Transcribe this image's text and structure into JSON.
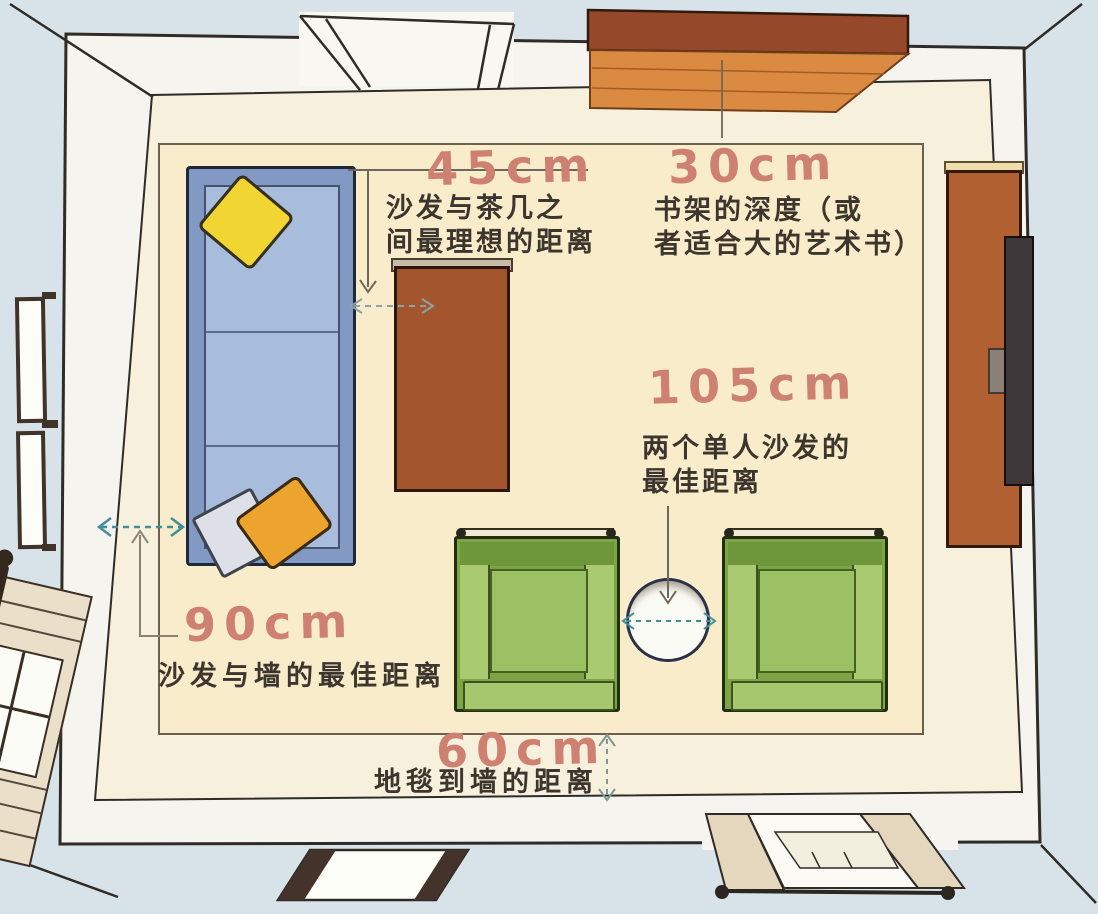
{
  "diagram": {
    "type": "living-room-furniture-spacing-floor-plan",
    "annotations": [
      {
        "value": "45cm",
        "label": "沙发与茶几之\n间最理想的距离"
      },
      {
        "value": "30cm",
        "label": "书架的深度（或\n者适合大的艺术书）"
      },
      {
        "value": "105cm",
        "label": "两个单人沙发的\n最佳距离"
      },
      {
        "value": "90cm",
        "label": "沙发与墙的最佳距离"
      },
      {
        "value": "60cm",
        "label": "地毯到墙的距离"
      }
    ],
    "furniture": [
      "sofa",
      "coffee-table",
      "bookshelf",
      "tv-cabinet",
      "tv",
      "armchair-left",
      "armchair-right",
      "round-side-table",
      "carpet",
      "left-wall-windows",
      "french-window",
      "bottom-window",
      "bottom-door"
    ],
    "colors": {
      "annotation_number": "#ce8170",
      "annotation_text": "#3d362e",
      "arrow_teal": "#418f98",
      "carpet": "#f9ecca",
      "sofa_blue": "#8299c3",
      "chair_green": "#7da445",
      "coffee_table_brown": "#a3552d",
      "bookshelf_orange": "#db8b41",
      "outside_blue": "#d8e3e9"
    }
  }
}
